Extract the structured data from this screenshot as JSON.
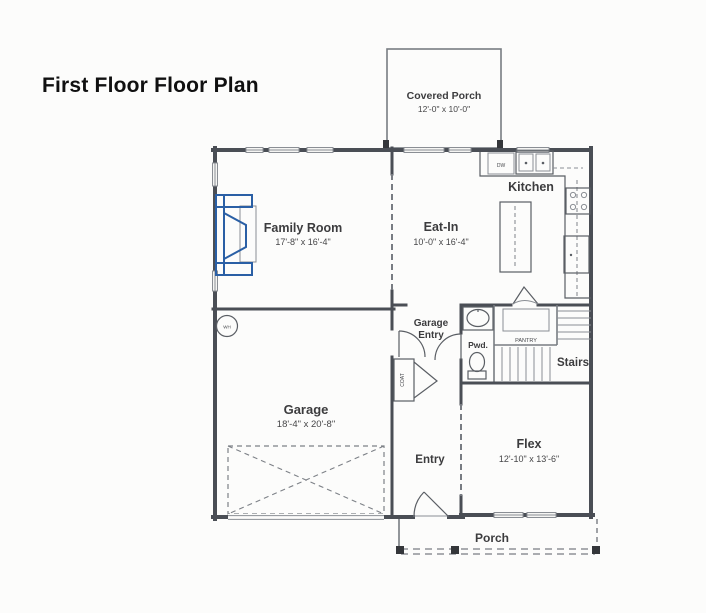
{
  "title": "First Floor Floor Plan",
  "rooms": {
    "covered_porch": {
      "name": "Covered Porch",
      "dims": "12'-0\" x 10'-0\""
    },
    "family_room": {
      "name": "Family Room",
      "dims": "17'-8\" x 16'-4\""
    },
    "eat_in": {
      "name": "Eat-In",
      "dims": "10'-0\" x 16'-4\""
    },
    "kitchen": {
      "name": "Kitchen"
    },
    "garage": {
      "name": "Garage",
      "dims": "18'-4\" x 20'-8\""
    },
    "garage_entry": {
      "line1": "Garage",
      "line2": "Entry"
    },
    "powder": {
      "name": "Pwd."
    },
    "pantry": {
      "name": "PANTRY"
    },
    "stairs": {
      "name": "Stairs"
    },
    "entry": {
      "name": "Entry"
    },
    "flex": {
      "name": "Flex",
      "dims": "12'-10\" x 13'-6\""
    },
    "porch": {
      "name": "Porch"
    }
  },
  "fixtures": {
    "water_heater": "WH",
    "dishwasher": "DW",
    "coat_closet": "COAT"
  },
  "colors": {
    "fireplace_blue": "#2a5fa5",
    "wall_gray": "#4a4e55"
  }
}
